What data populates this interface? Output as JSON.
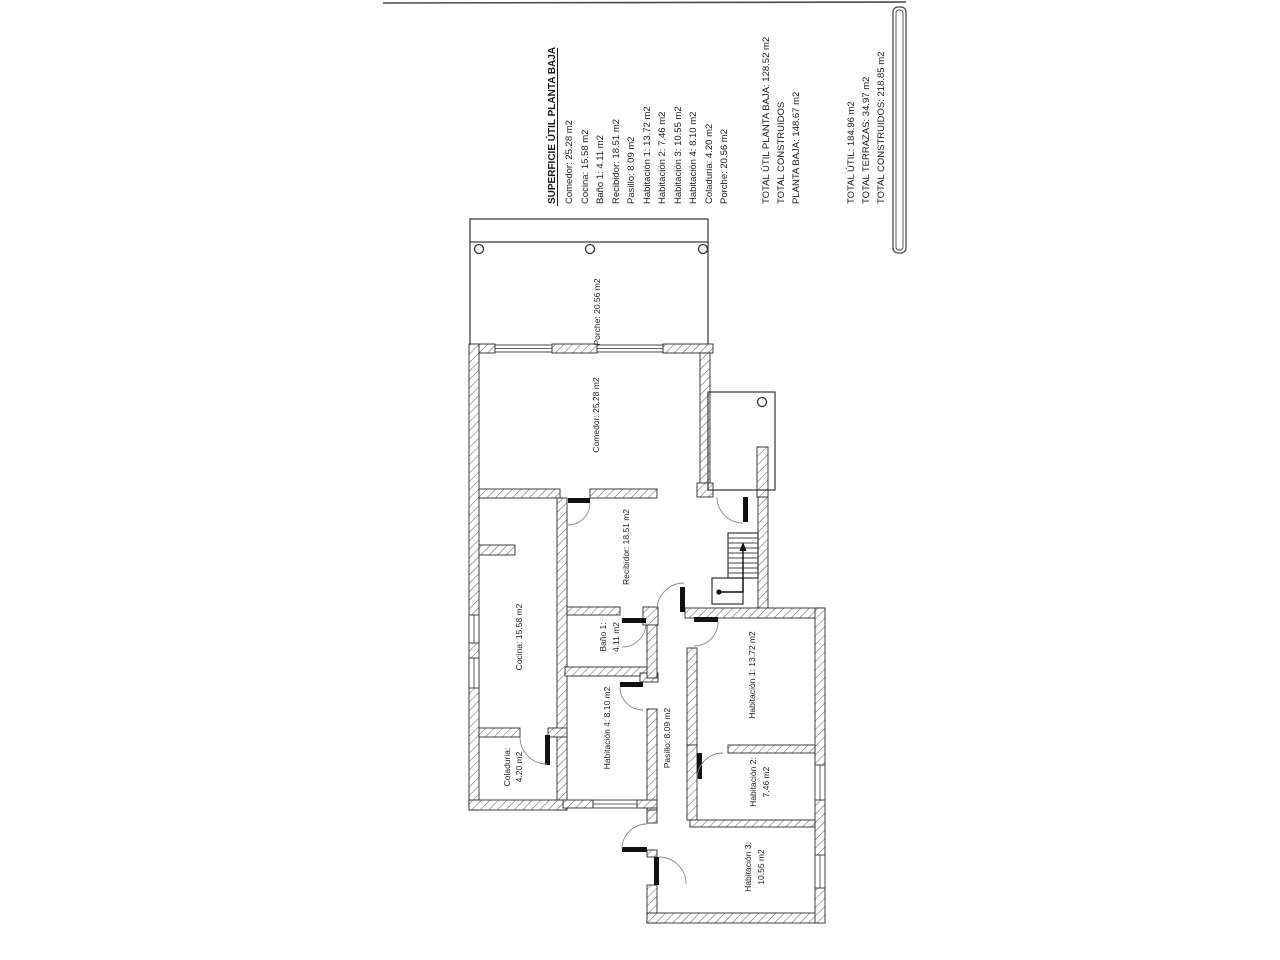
{
  "legend": {
    "title": "SUPERFICIE ÚTIL PLANTA BAJA",
    "items": [
      "Comedor: 25.28 m2",
      "Cocina: 15.58 m2",
      "Baño 1: 4.11 m2",
      "Recibidor: 18.51 m2",
      "Pasillo: 8.09 m2",
      "Habitación 1: 13.72 m2",
      "Habitación 2: 7.46 m2",
      "Habitación 3: 10.55 m2",
      "Habitación 4: 8.10 m2",
      "Coladuria: 4.20 m2",
      "Porche: 20.56 m2"
    ]
  },
  "totals_planta_baja": [
    "TOTAL ÚTIL PLANTA BAJA: 128.52 m2",
    "TOTAL CONSTRUIDOS",
    "PLANTA BAJA: 148.67 m2"
  ],
  "totals_general": [
    "TOTAL ÚTIL: 184.96 m2",
    "TOTAL TERRAZAS: 34.97 m2",
    "TOTAL CONSTRUIDOS: 218.85 m2"
  ],
  "plan_labels": {
    "porche": "Porche: 20.56 m2",
    "comedor": "Comedor: 25.28 m2",
    "recibidor": "Recibidor: 18.51 m2",
    "cocina": "Cocina: 15.58 m2",
    "bano_line1": "Baño 1:",
    "bano_line2": "4.11 m2",
    "pasillo": "Pasillo: 8.09 m2",
    "habitacion1": "Habitación 1: 13.72 m2",
    "habitacion2_line1": "Habitación 2:",
    "habitacion2_line2": "7.46 m2",
    "habitacion3_line1": "Habitación 3:",
    "habitacion3_line2": "10.55 m2",
    "habitacion4": "Habitación 4: 8.10 m2",
    "coladuria_line1": "Coladuria:",
    "coladuria_line2": "4.20 m2"
  },
  "colors": {
    "ink": "#1c1c1c",
    "wall_hatch": "#6a6a6a",
    "paper": "#ffffff"
  }
}
